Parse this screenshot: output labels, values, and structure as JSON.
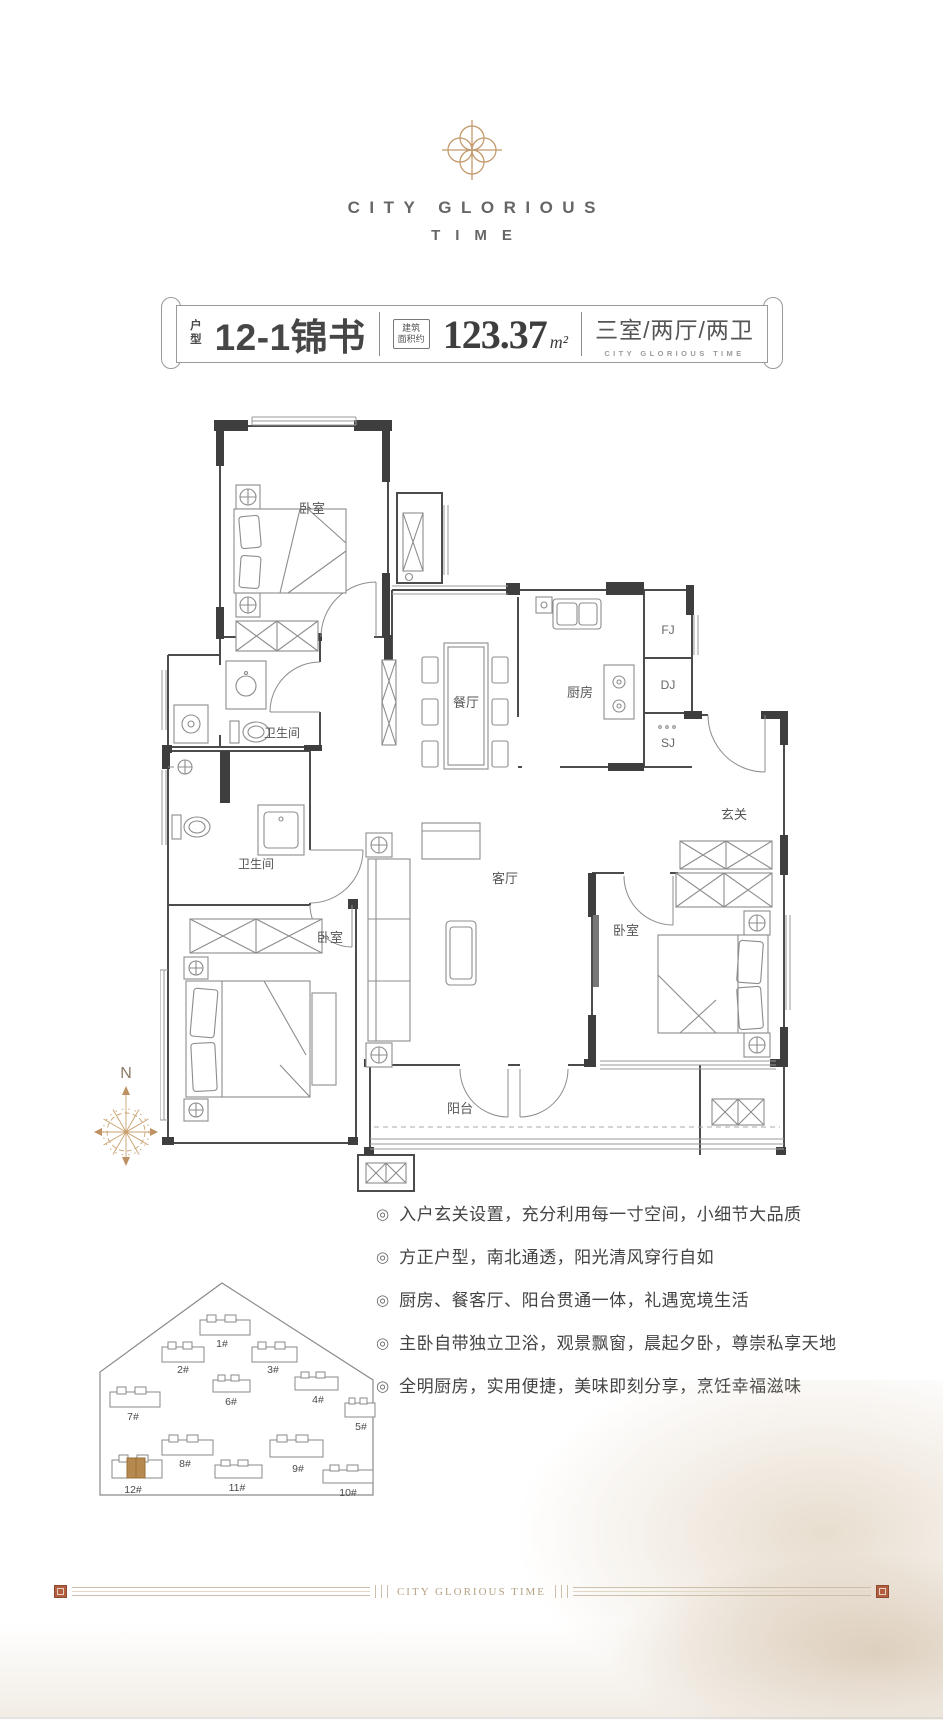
{
  "brand": {
    "line1": "CITY GLORIOUS",
    "line2": "TIME"
  },
  "banner": {
    "type_label_top": "户",
    "type_label_bottom": "型",
    "unit_name": "12-1锦书",
    "area_box_top": "建筑",
    "area_box_bottom": "面积约",
    "area_value": "123.37",
    "area_unit": "m²",
    "rooms_text": "三室/两厅/两卫",
    "rooms_sub": "CITY GLORIOUS TIME"
  },
  "plan": {
    "rooms": [
      {
        "name": "卧室"
      },
      {
        "name": "卫生间"
      },
      {
        "name": "卫生间"
      },
      {
        "name": "卧室"
      },
      {
        "name": "餐厅"
      },
      {
        "name": "厨房"
      },
      {
        "name": "FJ"
      },
      {
        "name": "DJ"
      },
      {
        "name": "SJ"
      },
      {
        "name": "玄关"
      },
      {
        "name": "卧室"
      },
      {
        "name": "客厅"
      },
      {
        "name": "阳台"
      }
    ]
  },
  "compass": {
    "north": "N"
  },
  "siteplan": {
    "highlighted": "12#",
    "buildings": [
      {
        "id": "1#"
      },
      {
        "id": "2#"
      },
      {
        "id": "3#"
      },
      {
        "id": "4#"
      },
      {
        "id": "5#"
      },
      {
        "id": "6#"
      },
      {
        "id": "7#"
      },
      {
        "id": "8#"
      },
      {
        "id": "9#"
      },
      {
        "id": "10#"
      },
      {
        "id": "11#"
      },
      {
        "id": "12#"
      }
    ]
  },
  "features": {
    "marker": "◎",
    "items": [
      "入户玄关设置，充分利用每一寸空间，小细节大品质",
      "方正户型，南北通透，阳光清风穿行自如",
      "厨房、餐客厅、阳台贯通一体，礼遇宽境生活",
      "主卧自带独立卫浴，观景飘窗，晨起夕卧，尊崇私享天地",
      "全明厨房，实用便捷，美味即刻分享，烹饪幸福滋味"
    ]
  },
  "footer": {
    "center_text": "CITY GLORIOUS TIME"
  },
  "colors": {
    "gold": "#c49a6c",
    "wall_dark": "#3e3e3e",
    "line_gray": "#6f6f6f",
    "text_dark": "#474747",
    "seal_red": "#b35f3f"
  }
}
